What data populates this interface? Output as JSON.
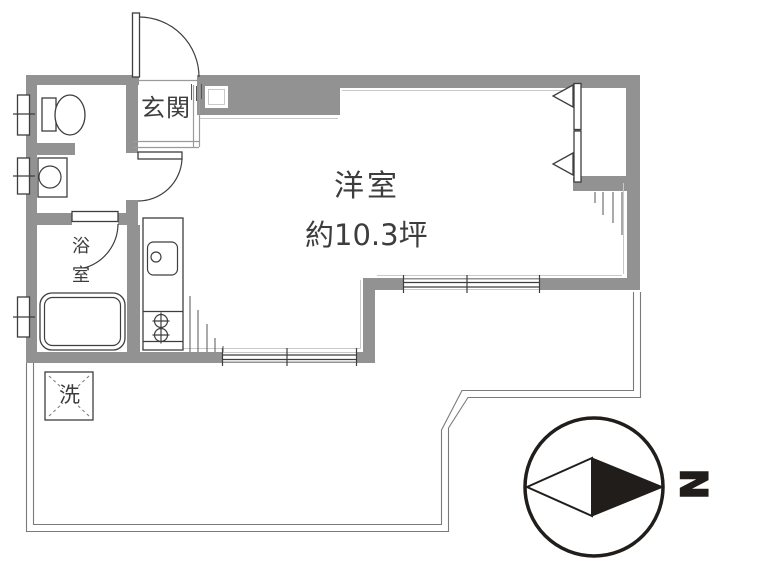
{
  "rooms": {
    "entrance": {
      "label": "玄関"
    },
    "main_room": {
      "label": "洋室",
      "area": "約10.3坪"
    },
    "bathroom": {
      "label": "浴室"
    },
    "laundry": {
      "label": "洗"
    }
  },
  "compass": {
    "north_label": "N"
  },
  "colors": {
    "wall": "#929292",
    "line": "#3e3e3e",
    "light_line": "#c9c9c9",
    "balcony_line": "#7a7a7a",
    "compass_black": "#211d1a",
    "background": "#ffffff"
  }
}
